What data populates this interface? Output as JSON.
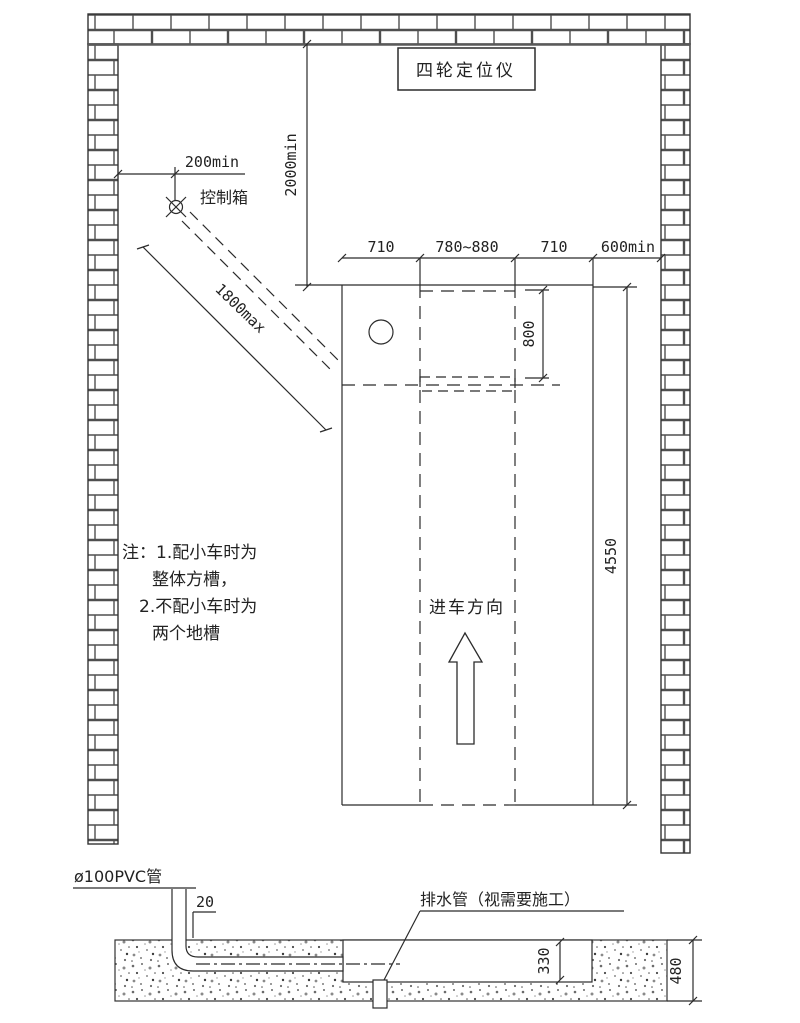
{
  "title": "四轮定位仪",
  "plan": {
    "dim_200min": "200min",
    "control_box": "控制箱",
    "dim_2000min": "2000min",
    "dim_1800max": "1800max",
    "dim_710_left": "710",
    "dim_780_880": "780~880",
    "dim_710_right": "710",
    "dim_600min": "600min",
    "dim_800": "800",
    "dim_4550": "4550",
    "direction": "进车方向",
    "notes": {
      "line1": "注：1.配小车时为",
      "line2": "整体方槽，",
      "line3": "2.不配小车时为",
      "line4": "两个地槽"
    }
  },
  "section": {
    "pvc_label": "ø100PVC管",
    "dim_20": "20",
    "drain_label": "排水管（视需要施工）",
    "dim_330": "330",
    "dim_480": "480"
  },
  "colors": {
    "line": "#2b2b2b",
    "mortar": "#4f4f4f",
    "background": "#ffffff"
  }
}
